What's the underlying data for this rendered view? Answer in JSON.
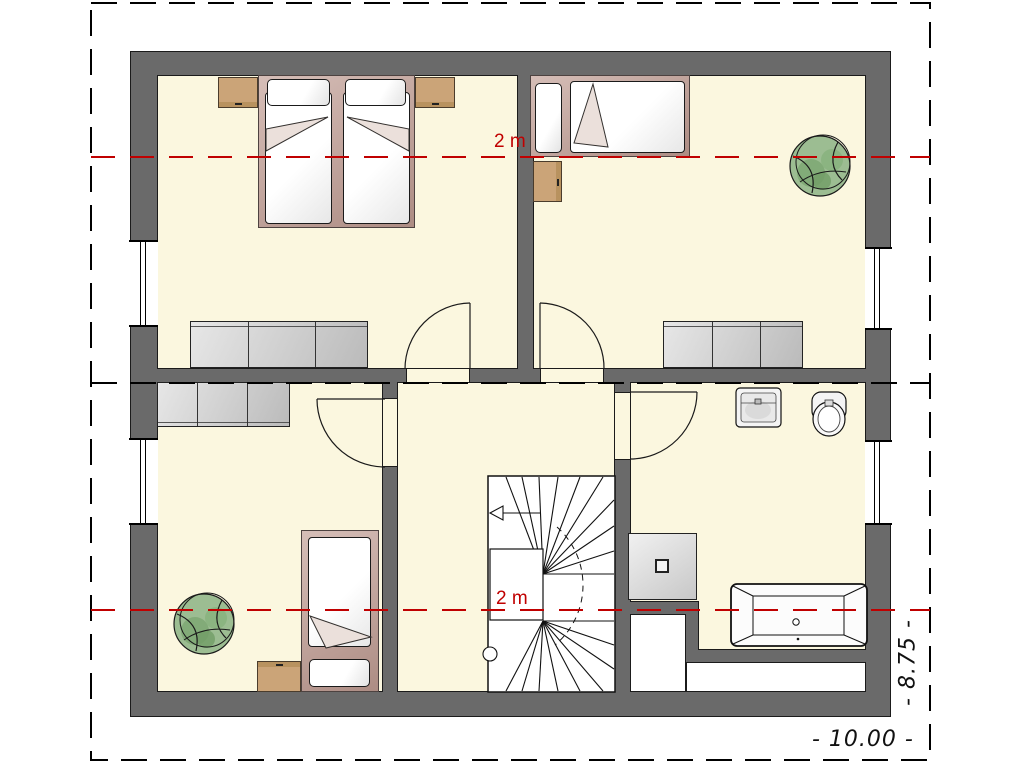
{
  "drawing": {
    "kind": "architectural floor plan, upper storey with furniture",
    "annotations": {
      "headroom_label_top": "2 m",
      "headroom_label_bottom": "2 m",
      "dimension_right": "- 8.75 -",
      "dimension_bottom": "- 10.00 -"
    },
    "colors": {
      "wall": "#6A6A6A",
      "floor": "#FBF7DF",
      "headroom_line": "#C00000",
      "section_line": "#000000",
      "plot_boundary": "#000000",
      "bed_frame": "#C6A59C",
      "nightstand": "#CBA478",
      "wardrobe": "#C9C9C9",
      "plant_foliage": "#8FB786",
      "fixture": "#F2F2F2"
    },
    "symbols": [
      {
        "name": "double-bed",
        "count": 1
      },
      {
        "name": "single-bed",
        "count": 2
      },
      {
        "name": "wardrobe",
        "count": 3
      },
      {
        "name": "nightstand",
        "count": 4
      },
      {
        "name": "plant",
        "count": 2
      },
      {
        "name": "winder-staircase",
        "count": 1
      },
      {
        "name": "shower",
        "count": 1
      },
      {
        "name": "washbasin",
        "count": 1
      },
      {
        "name": "toilet",
        "count": 1
      },
      {
        "name": "bathtub",
        "count": 1
      },
      {
        "name": "door-swing",
        "count": 4
      },
      {
        "name": "window",
        "count": 4
      }
    ]
  }
}
